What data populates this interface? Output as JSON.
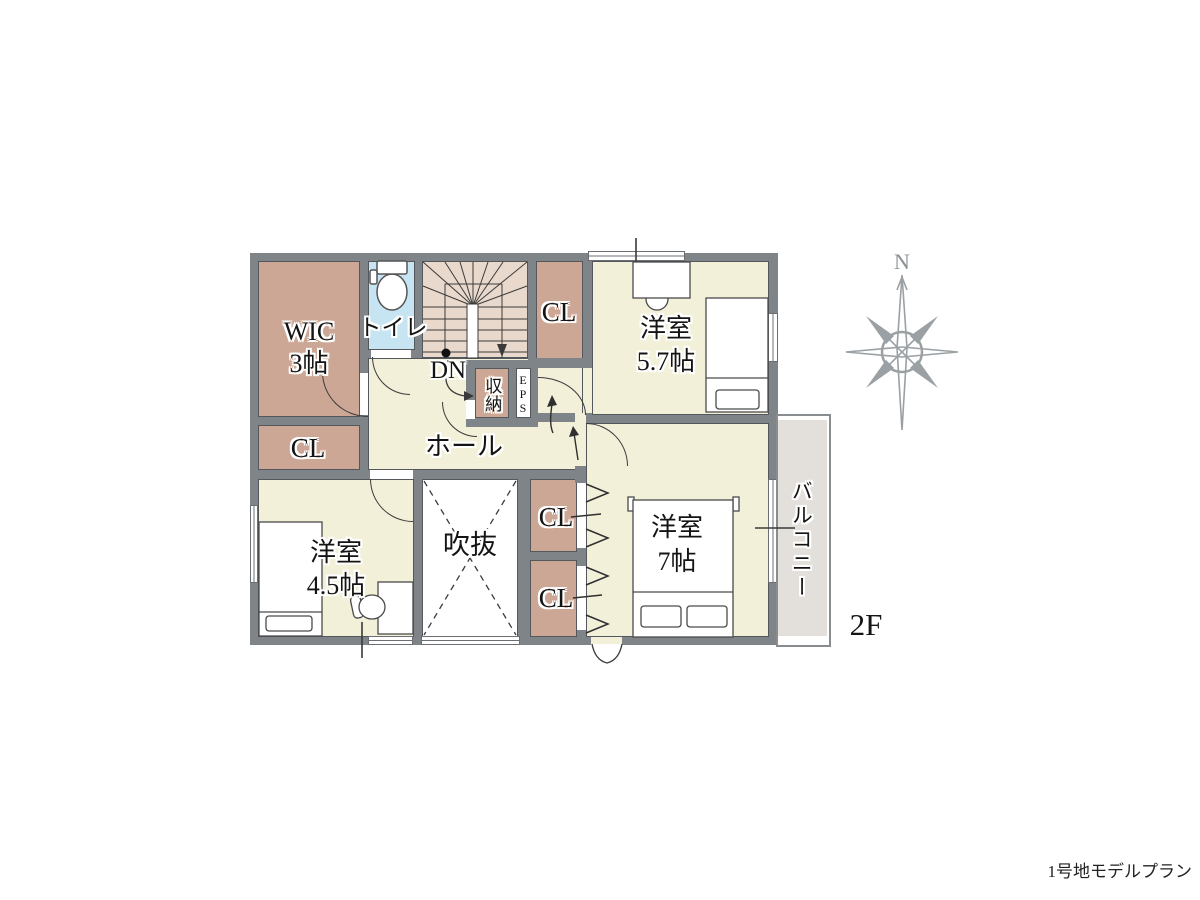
{
  "page": {
    "caption": "1号地モデルプラン",
    "floor_label": "2F",
    "compass_north": "N"
  },
  "rooms": {
    "wic": {
      "name": "WIC",
      "size": "3帖"
    },
    "toilet": {
      "name": "トイレ"
    },
    "stairs": {
      "direction_label": "DN"
    },
    "closet_top": {
      "name": "CL"
    },
    "bedroom_57": {
      "name": "洋室",
      "size": "5.7帖"
    },
    "hall": {
      "name": "ホール"
    },
    "storage": {
      "name": "収納"
    },
    "eps": {
      "name": "EPS"
    },
    "closet_left": {
      "name": "CL"
    },
    "bedroom_45": {
      "name": "洋室",
      "size": "4.5帖"
    },
    "void": {
      "name": "吹抜"
    },
    "closet_a": {
      "name": "CL"
    },
    "closet_b": {
      "name": "CL"
    },
    "bedroom_7": {
      "name": "洋室",
      "size": "7帖"
    },
    "balcony": {
      "name": "バルコニー"
    }
  },
  "colors": {
    "wall": "#7f8488",
    "room_cream": "#f3f0da",
    "closet_brown": "#cda795",
    "toilet_blue": "#c7e4f3",
    "stairs_pink": "#e9d9cc",
    "balcony_gray": "#e3e0db",
    "line": "#3a3a3a"
  }
}
